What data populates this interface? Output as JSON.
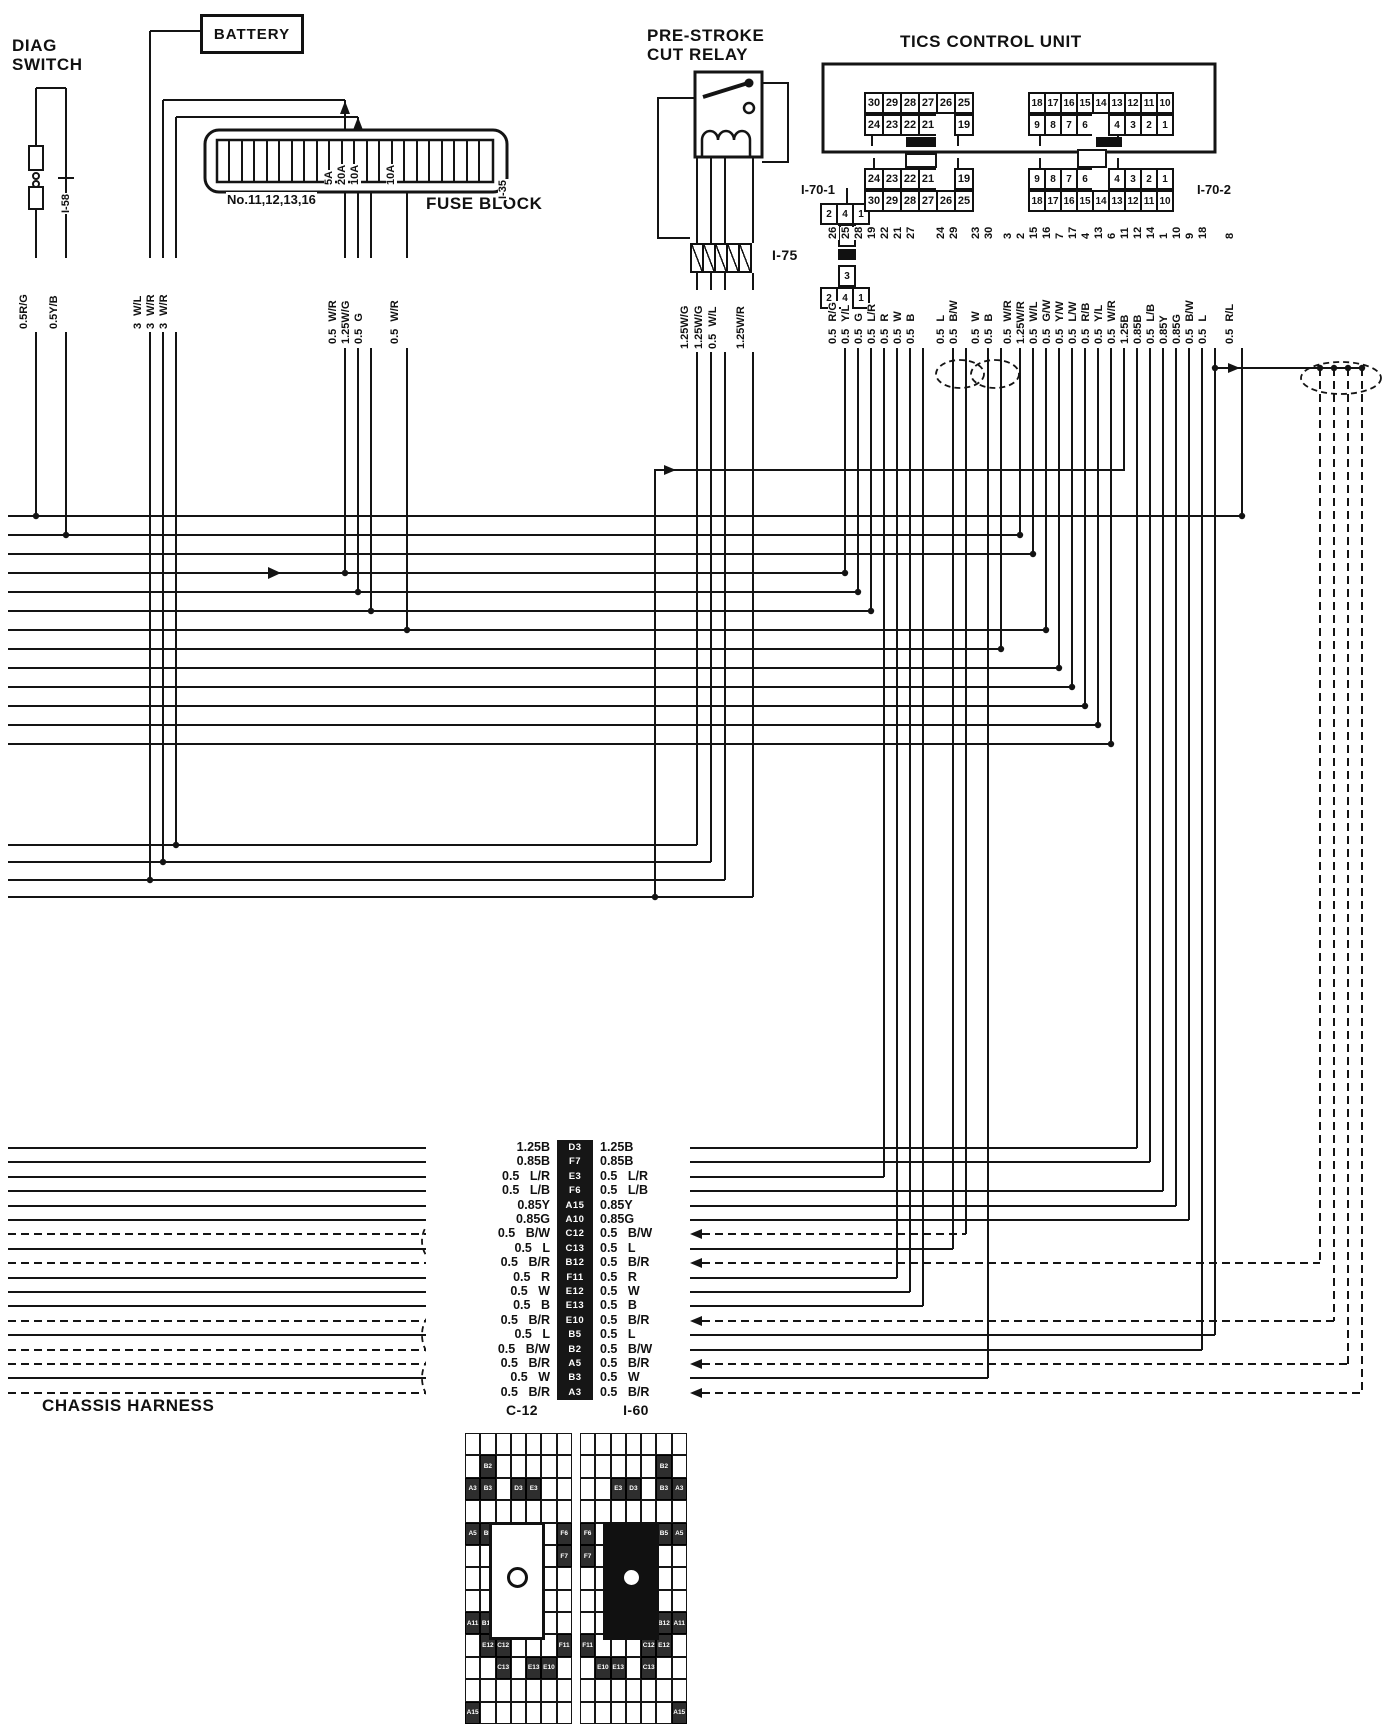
{
  "diag_switch": {
    "title": "DIAG\nSWITCH",
    "connector_label": "I-58",
    "wires": [
      "0.5R/G",
      "0.5Y/B"
    ]
  },
  "battery": {
    "label": "BATTERY",
    "feed_wires": [
      "3 W/L",
      "3 W/R",
      "3 W/R"
    ]
  },
  "fuse_block": {
    "label": "FUSE BLOCK",
    "connector_label": "I-35",
    "note": "No.11,12,13,16",
    "fuse_ratings": [
      "5A",
      "20A",
      "10A",
      "10A"
    ],
    "output_wires": [
      "0.5 W/R",
      "1.25W/G",
      "0.5 G",
      "0.5 W/R"
    ]
  },
  "relay": {
    "title": "PRE-STROKE\nCUT RELAY",
    "connector_label": "I-75",
    "wires": [
      "1.25W/G",
      "1.25W/G",
      "0.5 W/L",
      "1.25W/R"
    ]
  },
  "cross_top": {
    "row": [
      "2",
      "4",
      "1"
    ],
    "below": [
      "3"
    ]
  },
  "cross_bottom": {
    "above": [
      "3"
    ],
    "row": [
      "2",
      "4",
      "1"
    ]
  },
  "tics": {
    "title": "TICS CONTROL UNIT",
    "unit_left": {
      "row1": [
        "30",
        "29",
        "28",
        "27",
        "26",
        "25"
      ],
      "row2": [
        "24",
        "23",
        "22",
        "21",
        "",
        "19"
      ]
    },
    "unit_right": {
      "row1": [
        "18",
        "17",
        "16",
        "15",
        "14",
        "13",
        "12",
        "11",
        "10"
      ],
      "row2": [
        "9",
        "8",
        "7",
        "6",
        "",
        "4",
        "3",
        "2",
        "1"
      ]
    },
    "i70_1": {
      "label": "I-70-1",
      "row1": [
        "24",
        "23",
        "22",
        "21",
        "",
        "19"
      ],
      "row2": [
        "30",
        "29",
        "28",
        "27",
        "26",
        "25"
      ]
    },
    "i70_2": {
      "label": "I-70-2",
      "row1": [
        "9",
        "8",
        "7",
        "6",
        "",
        "4",
        "3",
        "2",
        "1"
      ],
      "row2": [
        "18",
        "17",
        "16",
        "15",
        "14",
        "13",
        "12",
        "11",
        "10"
      ]
    },
    "pins": [
      {
        "pin": "26",
        "wire": "0.5 R/G"
      },
      {
        "pin": "25",
        "wire": "0.5 Y/L"
      },
      {
        "pin": "28",
        "wire": "0.5 G"
      },
      {
        "pin": "19",
        "wire": "0.5 L/R"
      },
      {
        "pin": "22",
        "wire": "0.5 R"
      },
      {
        "pin": "21",
        "wire": "0.5 W"
      },
      {
        "pin": "27",
        "wire": "0.5 B"
      },
      {
        "pin": "24",
        "wire": "0.5 L"
      },
      {
        "pin": "29",
        "wire": "0.5 B/W"
      },
      {
        "pin": "23",
        "wire": "0.5 W"
      },
      {
        "pin": "30",
        "wire": "0.5 B"
      },
      {
        "pin": "3",
        "wire": "0.5 W/R"
      },
      {
        "pin": "2",
        "wire": "1.25W/R"
      },
      {
        "pin": "15",
        "wire": "0.5 W/L"
      },
      {
        "pin": "16",
        "wire": "0.5 G/W"
      },
      {
        "pin": "7",
        "wire": "0.5 Y/W"
      },
      {
        "pin": "17",
        "wire": "0.5 L/W"
      },
      {
        "pin": "4",
        "wire": "0.5 R/B"
      },
      {
        "pin": "13",
        "wire": "0.5 Y/L"
      },
      {
        "pin": "6",
        "wire": "0.5 W/R"
      },
      {
        "pin": "11",
        "wire": "1.25B"
      },
      {
        "pin": "12",
        "wire": "0.85B"
      },
      {
        "pin": "14",
        "wire": "0.5 L/B"
      },
      {
        "pin": "1",
        "wire": "0.85Y"
      },
      {
        "pin": "10",
        "wire": "0.85G"
      },
      {
        "pin": "9",
        "wire": "0.5 B/W"
      },
      {
        "pin": "18",
        "wire": "0.5 L"
      },
      {
        "pin": "8",
        "wire": "0.5 R/L"
      }
    ]
  },
  "chassis": {
    "label": "CHASSIS HARNESS"
  },
  "junctions": {
    "rows": [
      {
        "left": "1.25B",
        "code": "D3",
        "right": "1.25B"
      },
      {
        "left": "0.85B",
        "code": "F7",
        "right": "0.85B"
      },
      {
        "left": "0.5 L/R",
        "code": "E3",
        "right": "0.5 L/R"
      },
      {
        "left": "0.5 L/B",
        "code": "F6",
        "right": "0.5 L/B"
      },
      {
        "left": "0.85Y",
        "code": "A15",
        "right": "0.85Y"
      },
      {
        "left": "0.85G",
        "code": "A10",
        "right": "0.85G"
      },
      {
        "left": "0.5 B/W",
        "code": "C12",
        "right": "0.5 B/W"
      },
      {
        "left": "0.5 L",
        "code": "C13",
        "right": "0.5 L"
      },
      {
        "left": "0.5 B/R",
        "code": "B12",
        "right": "0.5 B/R"
      },
      {
        "left": "0.5 R",
        "code": "F11",
        "right": "0.5 R"
      },
      {
        "left": "0.5 W",
        "code": "E12",
        "right": "0.5 W"
      },
      {
        "left": "0.5 B",
        "code": "E13",
        "right": "0.5 B"
      },
      {
        "left": "0.5 B/R",
        "code": "E10",
        "right": "0.5 B/R"
      },
      {
        "left": "0.5 L",
        "code": "B5",
        "right": "0.5 L"
      },
      {
        "left": "0.5 B/W",
        "code": "B2",
        "right": "0.5 B/W"
      },
      {
        "left": "0.5 B/R",
        "code": "A5",
        "right": "0.5 B/R"
      },
      {
        "left": "0.5 W",
        "code": "B3",
        "right": "0.5 W"
      },
      {
        "left": "0.5 B/R",
        "code": "A3",
        "right": "0.5 B/R"
      }
    ]
  },
  "c12": {
    "label": "C-12",
    "grid": {
      "cols": 7,
      "rows": 13,
      "marks": [
        {
          "r": 2,
          "c": 2,
          "label": "B2"
        },
        {
          "r": 3,
          "c": 1,
          "label": "A3"
        },
        {
          "r": 3,
          "c": 2,
          "label": "B3"
        },
        {
          "r": 3,
          "c": 4,
          "label": "D3"
        },
        {
          "r": 3,
          "c": 5,
          "label": "E3"
        },
        {
          "r": 5,
          "c": 1,
          "label": "A5"
        },
        {
          "r": 5,
          "c": 2,
          "label": "B5"
        },
        {
          "r": 5,
          "c": 7,
          "label": "F6"
        },
        {
          "r": 6,
          "c": 7,
          "label": "F7"
        },
        {
          "r": 9,
          "c": 1,
          "label": "A11"
        },
        {
          "r": 9,
          "c": 2,
          "label": "B12"
        },
        {
          "r": 10,
          "c": 7,
          "label": "F11"
        },
        {
          "r": 10,
          "c": 2,
          "label": "E12"
        },
        {
          "r": 10,
          "c": 3,
          "label": "C12"
        },
        {
          "r": 11,
          "c": 3,
          "label": "C13"
        },
        {
          "r": 11,
          "c": 5,
          "label": "E13"
        },
        {
          "r": 11,
          "c": 6,
          "label": "E10"
        },
        {
          "r": 13,
          "c": 1,
          "label": "A15"
        }
      ]
    }
  },
  "i60": {
    "label": "I-60",
    "grid": {
      "cols": 7,
      "rows": 13,
      "marks": [
        {
          "r": 2,
          "c": 6,
          "label": "B2"
        },
        {
          "r": 3,
          "c": 7,
          "label": "A3"
        },
        {
          "r": 3,
          "c": 6,
          "label": "B3"
        },
        {
          "r": 3,
          "c": 4,
          "label": "D3"
        },
        {
          "r": 3,
          "c": 3,
          "label": "E3"
        },
        {
          "r": 5,
          "c": 7,
          "label": "A5"
        },
        {
          "r": 5,
          "c": 6,
          "label": "B5"
        },
        {
          "r": 5,
          "c": 1,
          "label": "F6"
        },
        {
          "r": 6,
          "c": 1,
          "label": "F7"
        },
        {
          "r": 9,
          "c": 7,
          "label": "A11"
        },
        {
          "r": 9,
          "c": 6,
          "label": "B12"
        },
        {
          "r": 10,
          "c": 1,
          "label": "F11"
        },
        {
          "r": 10,
          "c": 6,
          "label": "E12"
        },
        {
          "r": 10,
          "c": 5,
          "label": "C12"
        },
        {
          "r": 11,
          "c": 5,
          "label": "C13"
        },
        {
          "r": 11,
          "c": 3,
          "label": "E13"
        },
        {
          "r": 11,
          "c": 2,
          "label": "E10"
        },
        {
          "r": 13,
          "c": 7,
          "label": "A15"
        }
      ]
    }
  },
  "colors": {
    "line": "#141414",
    "paper": "#ffffff"
  }
}
